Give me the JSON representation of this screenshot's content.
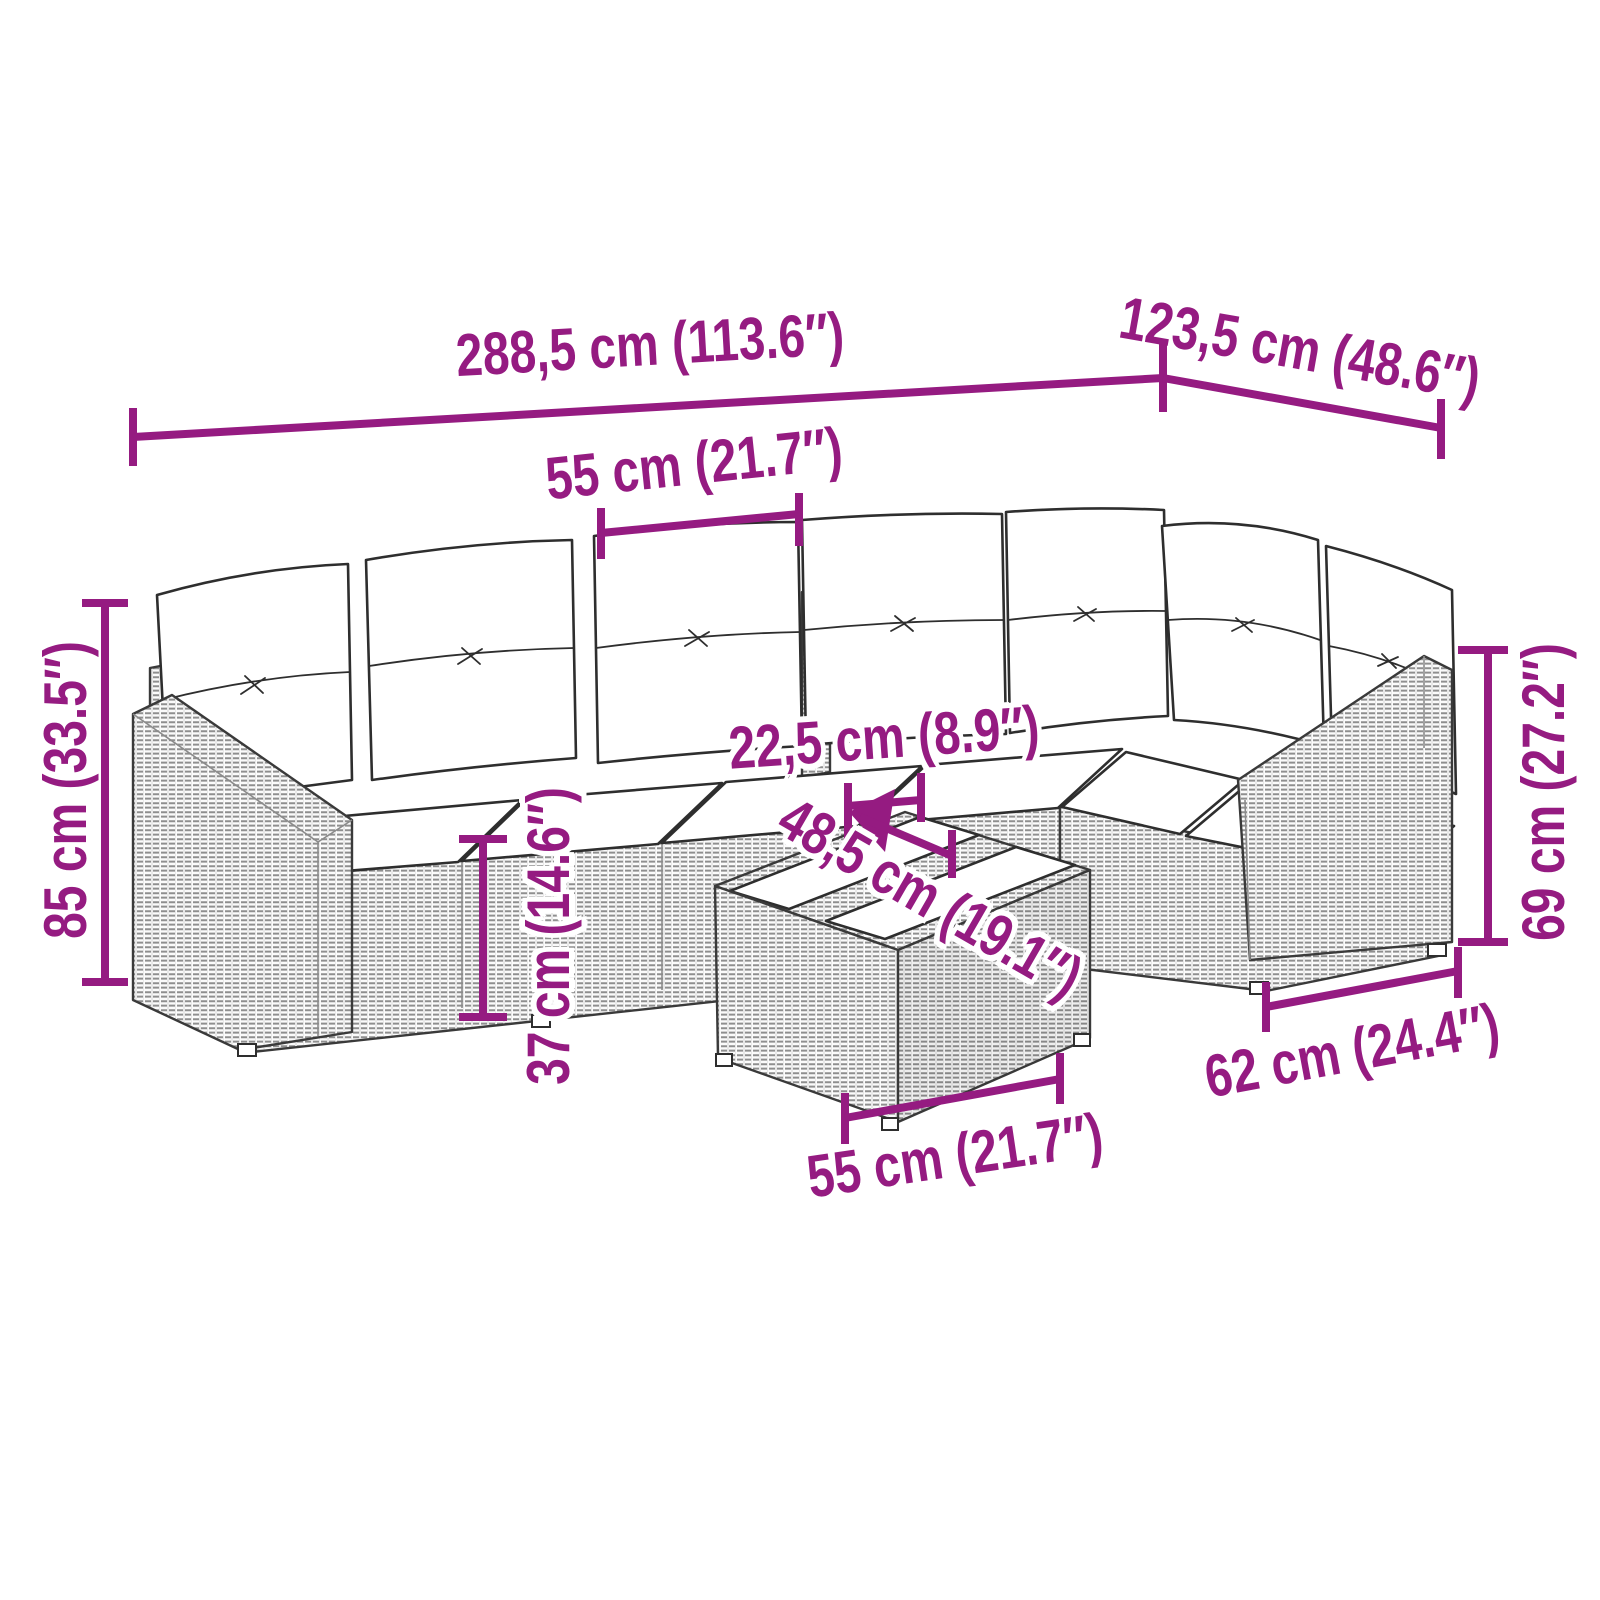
{
  "colors": {
    "accent": "#951B81",
    "drawing_line": "#3a3a3a"
  },
  "illustration": {
    "alt": "Line drawing of an L-shaped poly rattan garden lounge set with seven back cushions, seat cushions and a small rattan coffee table with slatted top"
  },
  "dimensions": {
    "labels": [
      {
        "id": "overall-width",
        "text": "288,5 cm (113.6″)"
      },
      {
        "id": "wing-depth",
        "text": "123,5 cm (48.6″)"
      },
      {
        "id": "seat-width",
        "text": "55 cm (21.7″)"
      },
      {
        "id": "overall-height",
        "text": "85 cm (33.5″)"
      },
      {
        "id": "table-gap",
        "text": "22,5 cm (8.9″)"
      },
      {
        "id": "table-depth",
        "text": "48,5 cm (19.1″)"
      },
      {
        "id": "seat-height",
        "text": "37 cm (14.6″)"
      },
      {
        "id": "back-height",
        "text": "69 cm (27.2″)"
      },
      {
        "id": "module-depth",
        "text": "62 cm (24.4″)"
      },
      {
        "id": "table-width",
        "text": "55 cm (21.7″)"
      }
    ]
  }
}
